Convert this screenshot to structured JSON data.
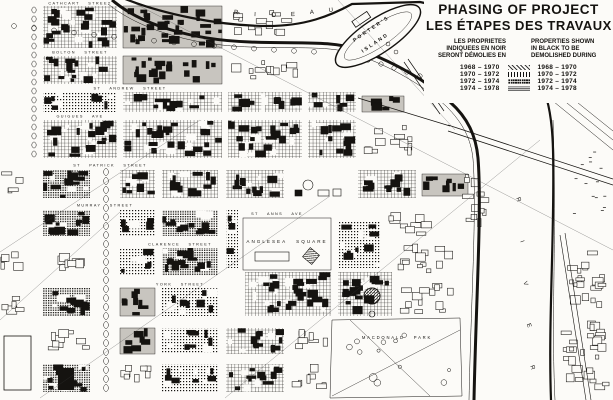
{
  "title": {
    "en": "PHASING OF PROJECT",
    "fr": "LES ÉTAPES DES TRAVAUX"
  },
  "legend": {
    "fr_lines": [
      "LES PROPRIETES",
      "INDIQUEES EN NOIR",
      "SERONT DÉMOLIES EN"
    ],
    "en_lines": [
      "PROPERTIES SHOWN",
      "IN BLACK TO BE",
      "DEMOLISHED DURING"
    ],
    "phases": [
      {
        "period": "1968 – 1970",
        "pattern": "light-diagonal-hatch"
      },
      {
        "period": "1970 – 1972",
        "pattern": "vertical-lines"
      },
      {
        "period": "1972 – 1974",
        "pattern": "dense-crosshatch"
      },
      {
        "period": "1974 – 1978",
        "pattern": "solid-grey"
      }
    ]
  },
  "map": {
    "river": {
      "name_top": "RIDEAU",
      "name_side": "RIVER"
    },
    "island": {
      "name_line1": "PORTER'S",
      "name_line2": "ISLAND"
    },
    "streets": [
      {
        "name": "CATHCART STREET",
        "x": 80,
        "y": 4.6,
        "rot": 0
      },
      {
        "name": "BOLTON STREET",
        "x": 80,
        "y": 53.6,
        "rot": 0
      },
      {
        "name": "ST ANDREW STREET",
        "x": 130,
        "y": 89.6,
        "rot": 0
      },
      {
        "name": "GUIGUES AVE",
        "x": 80,
        "y": 117.6,
        "rot": 0
      },
      {
        "name": "ST PATRICK STREET",
        "x": 110,
        "y": 166.6,
        "rot": 0
      },
      {
        "name": "MURRAY STREET",
        "x": 105,
        "y": 206.6,
        "rot": 0
      },
      {
        "name": "ST ANNS AVE",
        "x": 277,
        "y": 215.2,
        "rot": 0
      },
      {
        "name": "CLARENCE STREET",
        "x": 180,
        "y": 245.6,
        "rot": 0
      },
      {
        "name": "YORK STREET",
        "x": 180,
        "y": 285.6,
        "rot": 0
      }
    ],
    "places": [
      {
        "name": "ANGLESEA SQUARE",
        "x": 287,
        "y": 243
      },
      {
        "name": "MACDONALD PARK",
        "x": 397,
        "y": 339
      }
    ]
  },
  "colors": {
    "ink": "#151310",
    "paper": "#fcfbf8",
    "slab": "#c8c5bf"
  }
}
